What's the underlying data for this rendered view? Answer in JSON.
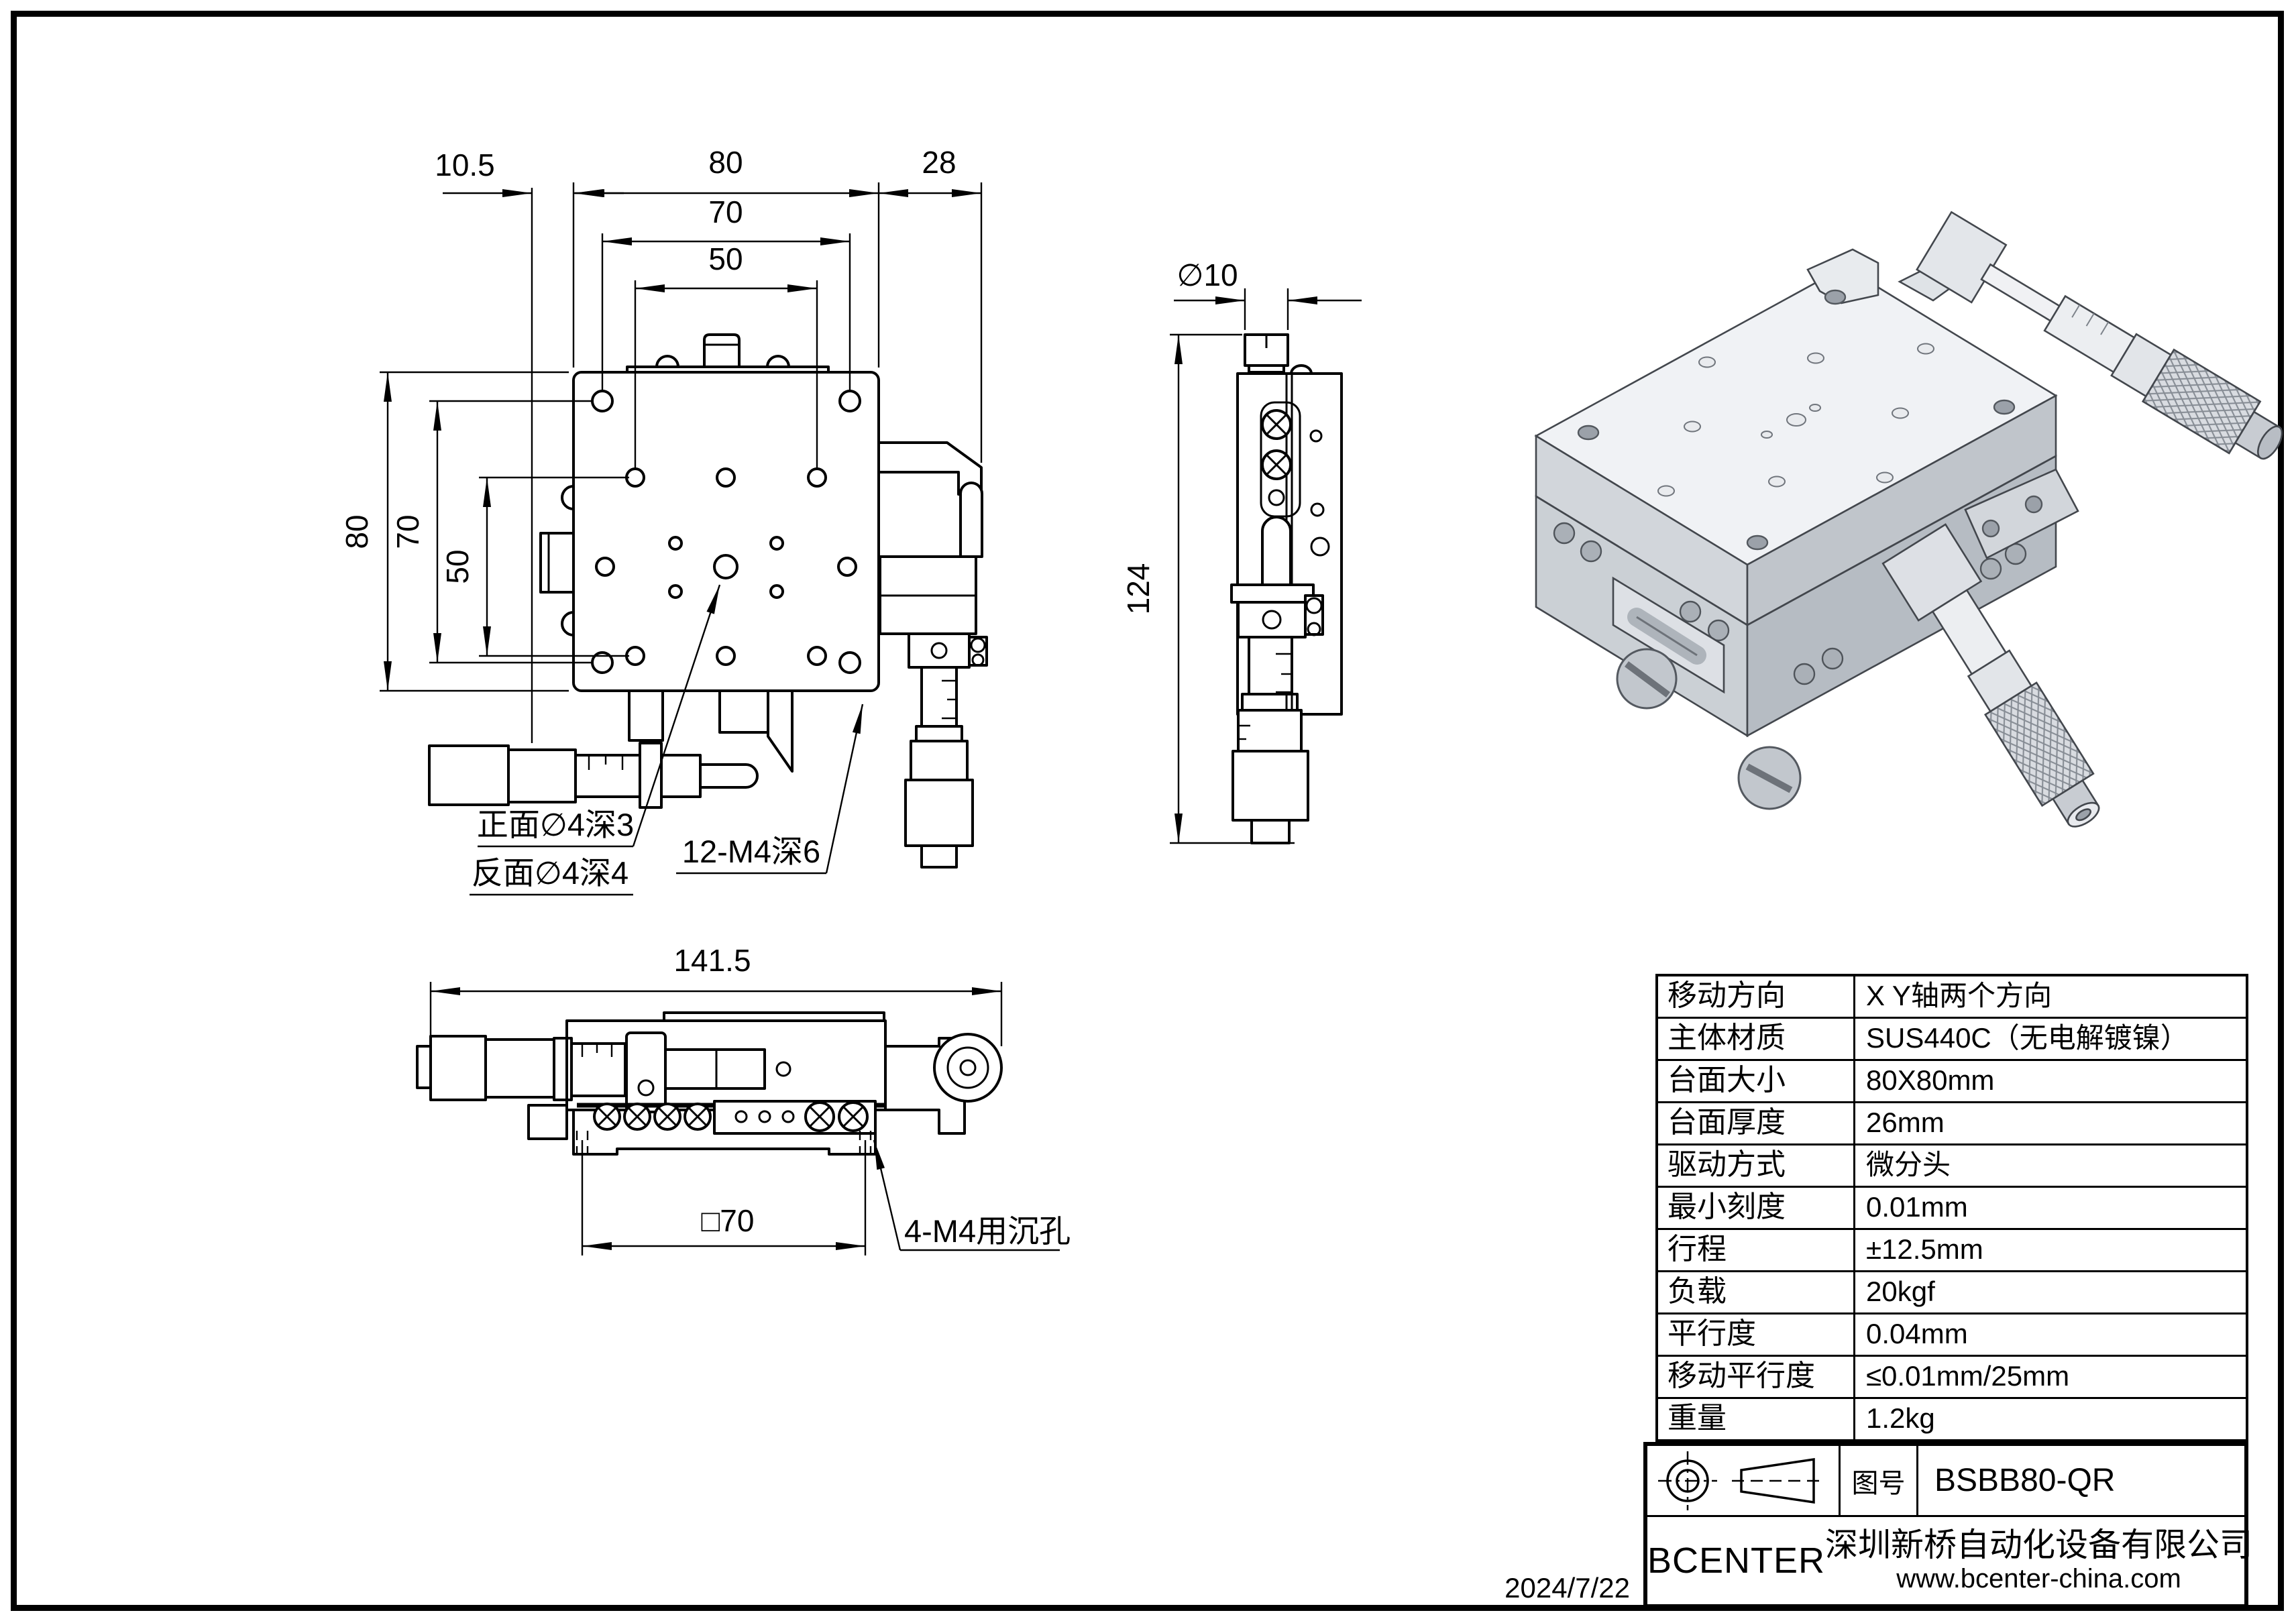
{
  "sheet": {
    "date": "2024/7/22"
  },
  "front_view": {
    "dim_left_offset": "10.5",
    "dim_width": "80",
    "dim_right_offset": "28",
    "dim_hole_span_70": "70",
    "dim_hole_span_50": "50",
    "dim_height": "80",
    "dim_vspan_70": "70",
    "dim_vspan_50": "50",
    "label_front_hole": "正面∅4深3",
    "label_back_hole": "反面∅4深4",
    "label_thread": "12-M4深6"
  },
  "side_view": {
    "dim_diameter": "∅10",
    "dim_height": "124"
  },
  "bottom_view": {
    "dim_length": "141.5",
    "dim_square": "□70",
    "label_counterbore": "4-M4用沉孔"
  },
  "spec_table": {
    "rows": [
      {
        "label": "移动方向",
        "value": "X Y轴两个方向"
      },
      {
        "label": "主体材质",
        "value": "SUS440C（无电解镀镍）"
      },
      {
        "label": "台面大小",
        "value": "80X80mm"
      },
      {
        "label": "台面厚度",
        "value": "26mm"
      },
      {
        "label": "驱动方式",
        "value": "微分头"
      },
      {
        "label": "最小刻度",
        "value": "0.01mm"
      },
      {
        "label": "行程",
        "value": "±12.5mm"
      },
      {
        "label": "负载",
        "value": "20kgf"
      },
      {
        "label": "平行度",
        "value": "0.04mm"
      },
      {
        "label": "移动平行度",
        "value": "≤0.01mm/25mm"
      },
      {
        "label": "重量",
        "value": "1.2kg"
      }
    ]
  },
  "title_block": {
    "drawing_no_label": "图号",
    "drawing_no": "BSBB80-QR",
    "brand": "BCENTER",
    "company": "深圳新桥自动化设备有限公司",
    "website": "www.bcenter-china.com"
  }
}
